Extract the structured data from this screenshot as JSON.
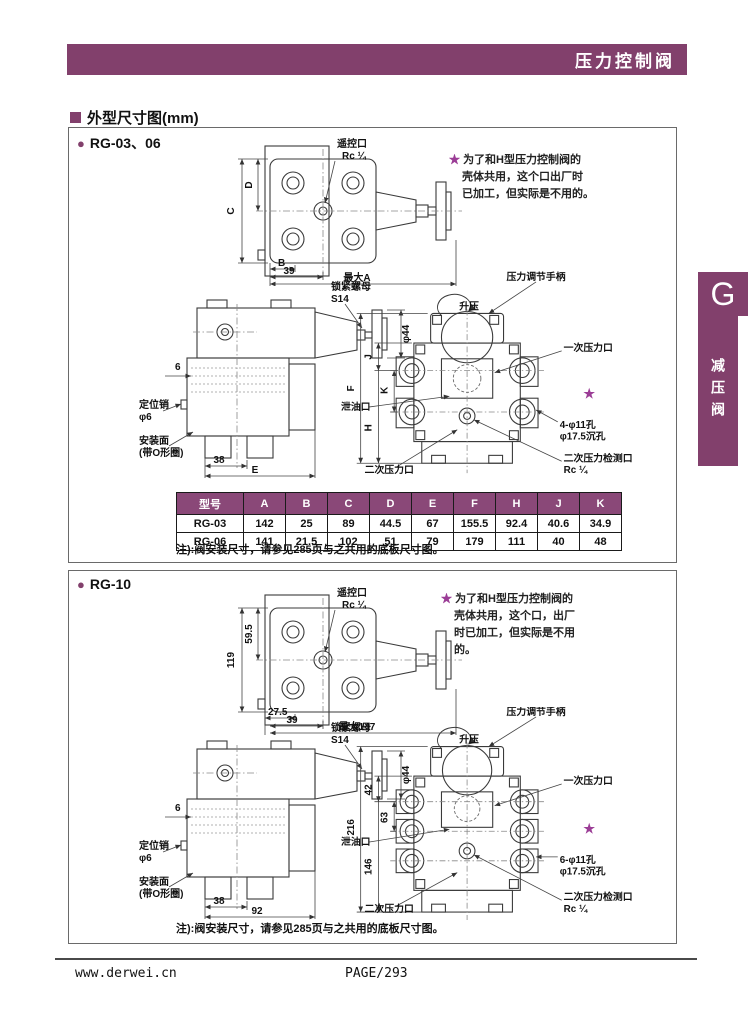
{
  "header": {
    "title": "压力控制阀"
  },
  "section": {
    "title": "外型尺寸图(mm)"
  },
  "side_tab": {
    "letter": "G",
    "label": "减压阀"
  },
  "footer": {
    "website": "www.derwei.cn",
    "page": "PAGE/293"
  },
  "colors": {
    "accent": "#82406c",
    "table_header": "#8a4878",
    "star": "#9b3d96",
    "line": "#3a3a3a"
  },
  "rg03": {
    "bullet": "●",
    "title": "RG-03、06",
    "note_star": {
      "star": "★",
      "line1": "为了和H型压力控制阀的",
      "line2": "壳体共用，这个口出厂时",
      "line3": "已加工，但实际是不用的。"
    },
    "top": {
      "port_label": "遥控口",
      "port_thread": "Rc ¼",
      "dim_c": "C",
      "dim_d": "D",
      "dim_b": "B",
      "dim_39": "39",
      "dim_a": "最大A"
    },
    "side": {
      "nut": "锁紧螺母",
      "nut_size": "S14",
      "dia44": "φ44",
      "dim_6": "6",
      "pin": "定位销",
      "pin_dia": "φ6",
      "mount1": "安装面",
      "mount2": "(带O形圈)",
      "dim_38": "38",
      "dim_e": "E"
    },
    "front": {
      "handle": "压力调节手柄",
      "raise": "升压",
      "primary": "一次压力口",
      "dim_f": "F",
      "dim_j": "J",
      "dim_k": "K",
      "dim_h": "H",
      "drain": "泄油口",
      "secondary": "二次压力口",
      "holes1": "4-φ11孔",
      "holes2": "φ17.5沉孔",
      "gauge1": "二次压力检测口",
      "gauge2": "Rc ¼",
      "star": "★"
    },
    "table": {
      "headers": [
        "型号",
        "A",
        "B",
        "C",
        "D",
        "E",
        "F",
        "H",
        "J",
        "K"
      ],
      "rows": [
        [
          "RG-03",
          "142",
          "25",
          "89",
          "44.5",
          "67",
          "155.5",
          "92.4",
          "40.6",
          "34.9"
        ],
        [
          "RG-06",
          "141",
          "21.5",
          "102",
          "51",
          "79",
          "179",
          "111",
          "40",
          "48"
        ]
      ]
    },
    "note": "注):阀安装尺寸，请参见285页与之共用的底板尺寸图。"
  },
  "rg10": {
    "bullet": "●",
    "title": "RG-10",
    "note_star": {
      "star": "★",
      "line1": "为了和H型压力控制阀的",
      "line2": "壳体共用，这个口，出厂",
      "line3": "时已加工，但实际是不用",
      "line4": "的。"
    },
    "top": {
      "port_label": "遥控口",
      "port_thread": "Rc ¼",
      "dim_119": "119",
      "dim_595": "59.5",
      "dim_275": "27.5",
      "dim_39": "39",
      "dim_max": "最大147"
    },
    "side": {
      "nut": "锁紧螺母",
      "nut_size": "S14",
      "dia44": "φ44",
      "dim_6": "6",
      "pin": "定位销",
      "pin_dia": "φ6",
      "mount1": "安装面",
      "mount2": "(带O形圈)",
      "dim_38": "38",
      "dim_92": "92"
    },
    "front": {
      "handle": "压力调节手柄",
      "raise": "升压",
      "primary": "一次压力口",
      "dim_216": "216",
      "dim_42": "42",
      "dim_63": "63",
      "dim_146": "146",
      "drain": "泄油口",
      "secondary": "二次压力口",
      "holes1": "6-φ11孔",
      "holes2": "φ17.5沉孔",
      "gauge1": "二次压力检测口",
      "gauge2": "Rc ¼",
      "star": "★"
    },
    "note": "注):阀安装尺寸，请参见285页与之共用的底板尺寸图。"
  }
}
